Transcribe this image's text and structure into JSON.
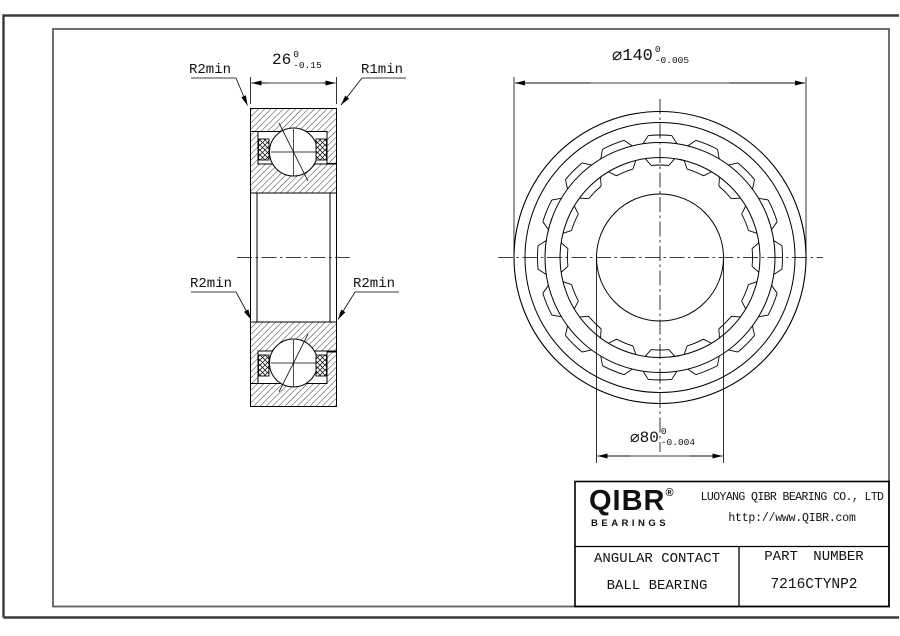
{
  "section_view": {
    "labels": {
      "r2min_top_left": "R2min",
      "r1min_top_right": "R1min",
      "r2min_mid_left": "R2min",
      "r2min_mid_right": "R2min"
    },
    "width_dim": {
      "value": "26",
      "sup": "0",
      "sub": "-0.15"
    }
  },
  "front_view": {
    "od_dim": {
      "symbol": "⌀",
      "value": "140",
      "sup": "0",
      "sub": "-0.005"
    },
    "bore_dim": {
      "symbol": "⌀",
      "value": "80",
      "sup": "0",
      "sub": "-0.004"
    }
  },
  "title_block": {
    "logo": {
      "name": "QIBR",
      "registered": "®",
      "sub": "BEARINGS"
    },
    "company": "LUOYANG QIBR BEARING CO., LTD",
    "website": "http://www.QIBR.com",
    "product_line1": "ANGULAR CONTACT",
    "product_line2": "BALL BEARING",
    "part_label": "PART NUMBER",
    "part_number": "7216CTYNP2"
  },
  "colors": {
    "ink": "#111111",
    "frame_outer": "#3a3a3a",
    "frame_inner": "#5f5f5f"
  }
}
